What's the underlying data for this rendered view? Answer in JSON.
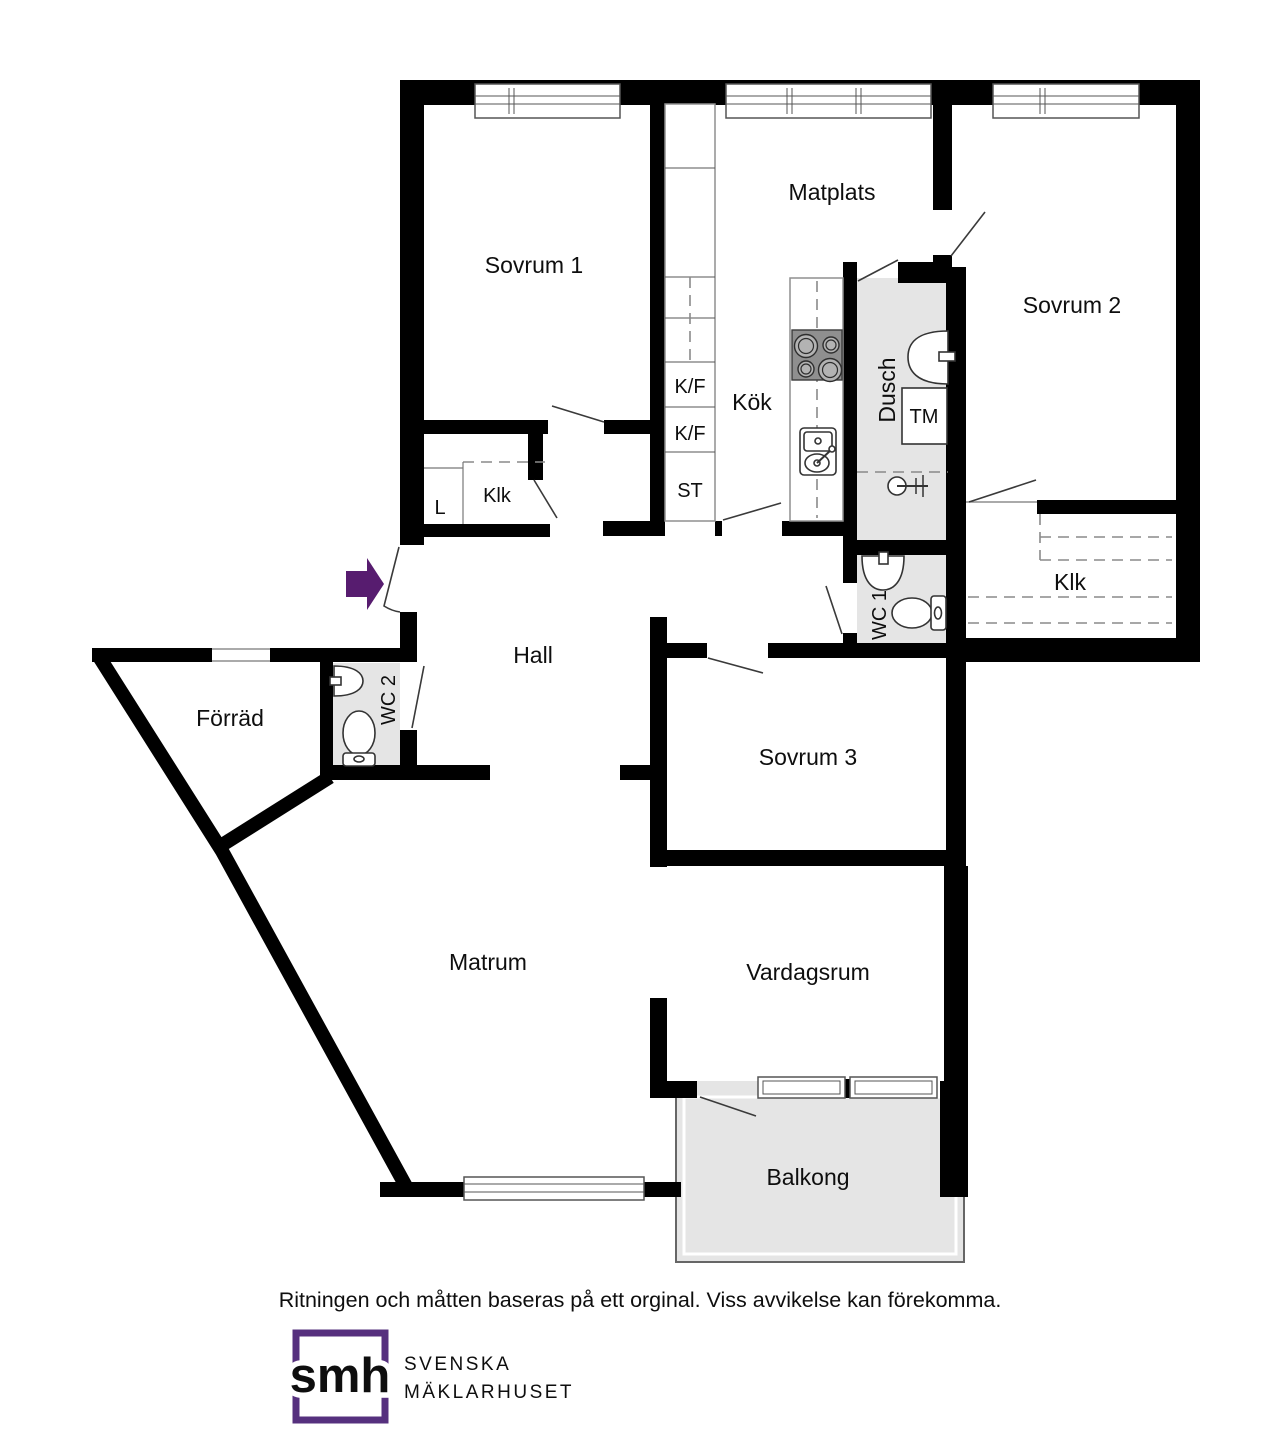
{
  "plan": {
    "room_labels": {
      "sovrum1": "Sovrum 1",
      "matplats": "Matplats",
      "sovrum2": "Sovrum 2",
      "kok": "Kök",
      "dusch": "Dusch",
      "wc1": "WC 1",
      "wc2": "WC 2",
      "klk": "Klk",
      "hall": "Hall",
      "forrad": "Förräd",
      "sovrum3": "Sovrum 3",
      "matrum": "Matrum",
      "vardagsrum": "Vardagsrum",
      "balkong": "Balkong"
    },
    "fixture_labels": {
      "kf": "K/F",
      "st": "ST",
      "l": "L",
      "tm": "TM"
    },
    "colors": {
      "wall": "#000000",
      "wet_room_floor": "#e5e5e5",
      "balcony_floor": "#e5e5e5",
      "entrance_arrow": "#571c6f",
      "stove": "#8f8f8f"
    }
  },
  "footer": {
    "disclaimer": "Ritningen och måtten baseras på ett orginal. Viss avvikelse kan förekomma."
  },
  "logo": {
    "monogram": "smh",
    "name_line1": "SVENSKA",
    "name_line2": "MÄKLARHUSET",
    "purple": "#56307e",
    "text_gray": "#4b4b52"
  }
}
